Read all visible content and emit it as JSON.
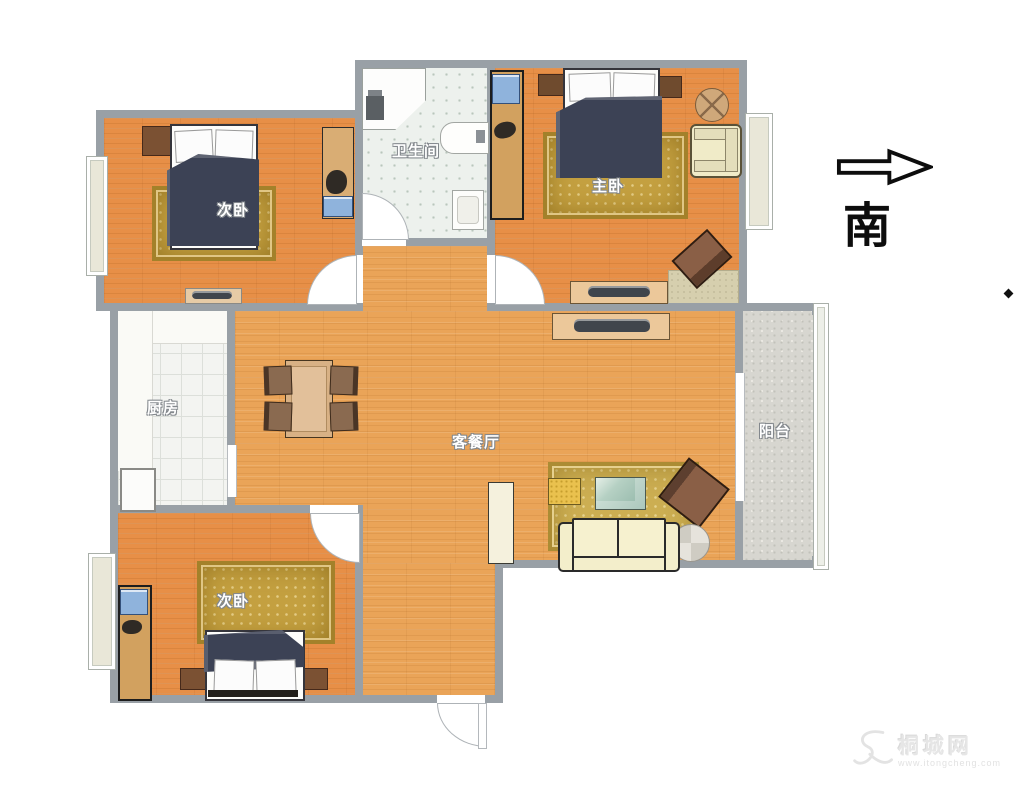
{
  "compass": {
    "direction_label": "南"
  },
  "rooms": {
    "bedroom_top": {
      "label": "次卧"
    },
    "master_bedroom": {
      "label": "主卧"
    },
    "bathroom": {
      "label": "卫生间"
    },
    "kitchen": {
      "label": "厨房"
    },
    "living_dining": {
      "label": "客餐厅"
    },
    "balcony": {
      "label": "阳台"
    },
    "bedroom_bottom": {
      "label": "次卧"
    }
  },
  "watermark": {
    "site_name": "桐城网",
    "site_url": "www.itongcheng.com"
  },
  "colors": {
    "wall": "#99a0a6",
    "bedroom_floor": "#e78f47",
    "living_floor": "#eaa458",
    "rug_gold": "#c4a040",
    "blanket_navy": "#3c4255",
    "kitchen_tile": "#f3f4f1",
    "bathroom_tile": "#edf1ed",
    "balcony_floor": "#d7d6d0",
    "sofa_cream": "#f3eecb",
    "compass_ink": "#0d0d0d"
  }
}
